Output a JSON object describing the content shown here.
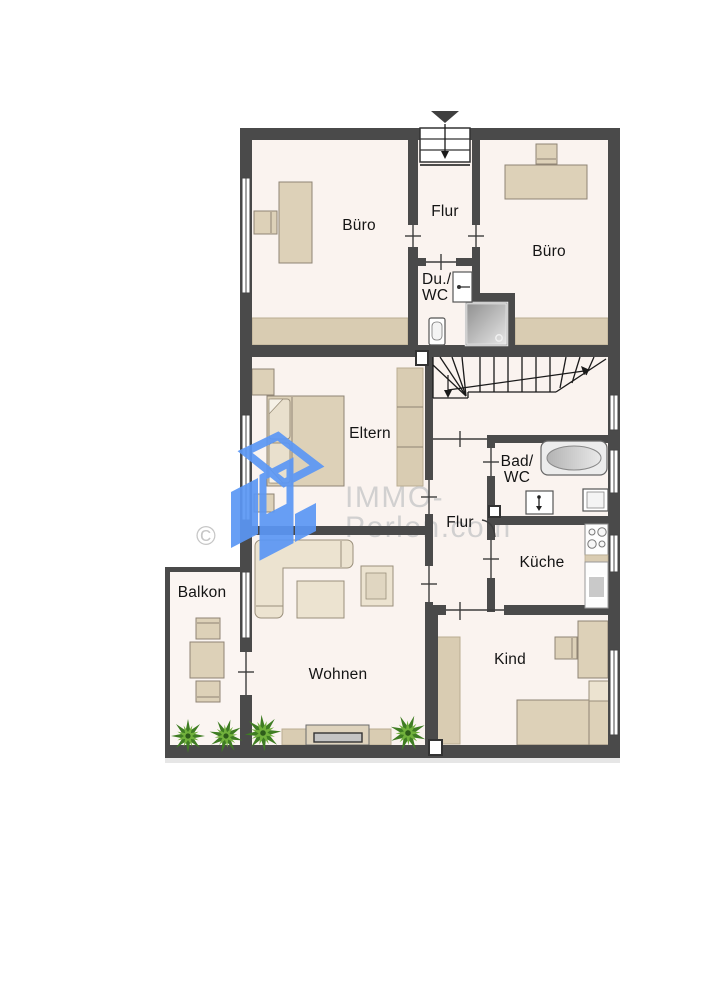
{
  "rooms": {
    "buero_left": {
      "label": "Büro"
    },
    "flur_top": {
      "label": "Flur"
    },
    "du_wc": {
      "line1": "Du./",
      "line2": "WC"
    },
    "buero_right": {
      "label": "Büro"
    },
    "eltern": {
      "label": "Eltern"
    },
    "bad_wc": {
      "line1": "Bad/",
      "line2": "WC"
    },
    "flur_mid": {
      "label": "Flur"
    },
    "kueche": {
      "label": "Küche"
    },
    "balkon": {
      "label": "Balkon"
    },
    "wohnen": {
      "label": "Wohnen"
    },
    "kind": {
      "label": "Kind"
    }
  },
  "watermark": {
    "copyright": "©",
    "brand_line1": "IMMO-",
    "brand_line2": "Perlen.com"
  },
  "icons": {
    "entrance_arrow": "entrance-arrow-icon",
    "staircase": "winder-staircase",
    "plant": "plant-icon",
    "logo": "immo-perlen-logo"
  },
  "colors": {
    "wall": "#4a4a4a",
    "floor": "#faf3ef",
    "furniture": "#ddd1b8",
    "furniture_light": "#ece3d0",
    "logo_blue": "#5b97f5",
    "watermark_gray": "#c9c9c9",
    "plant_green_dark": "#3f7d23",
    "plant_green_light": "#71b13c",
    "shower_gray": "#a8a8a8"
  }
}
